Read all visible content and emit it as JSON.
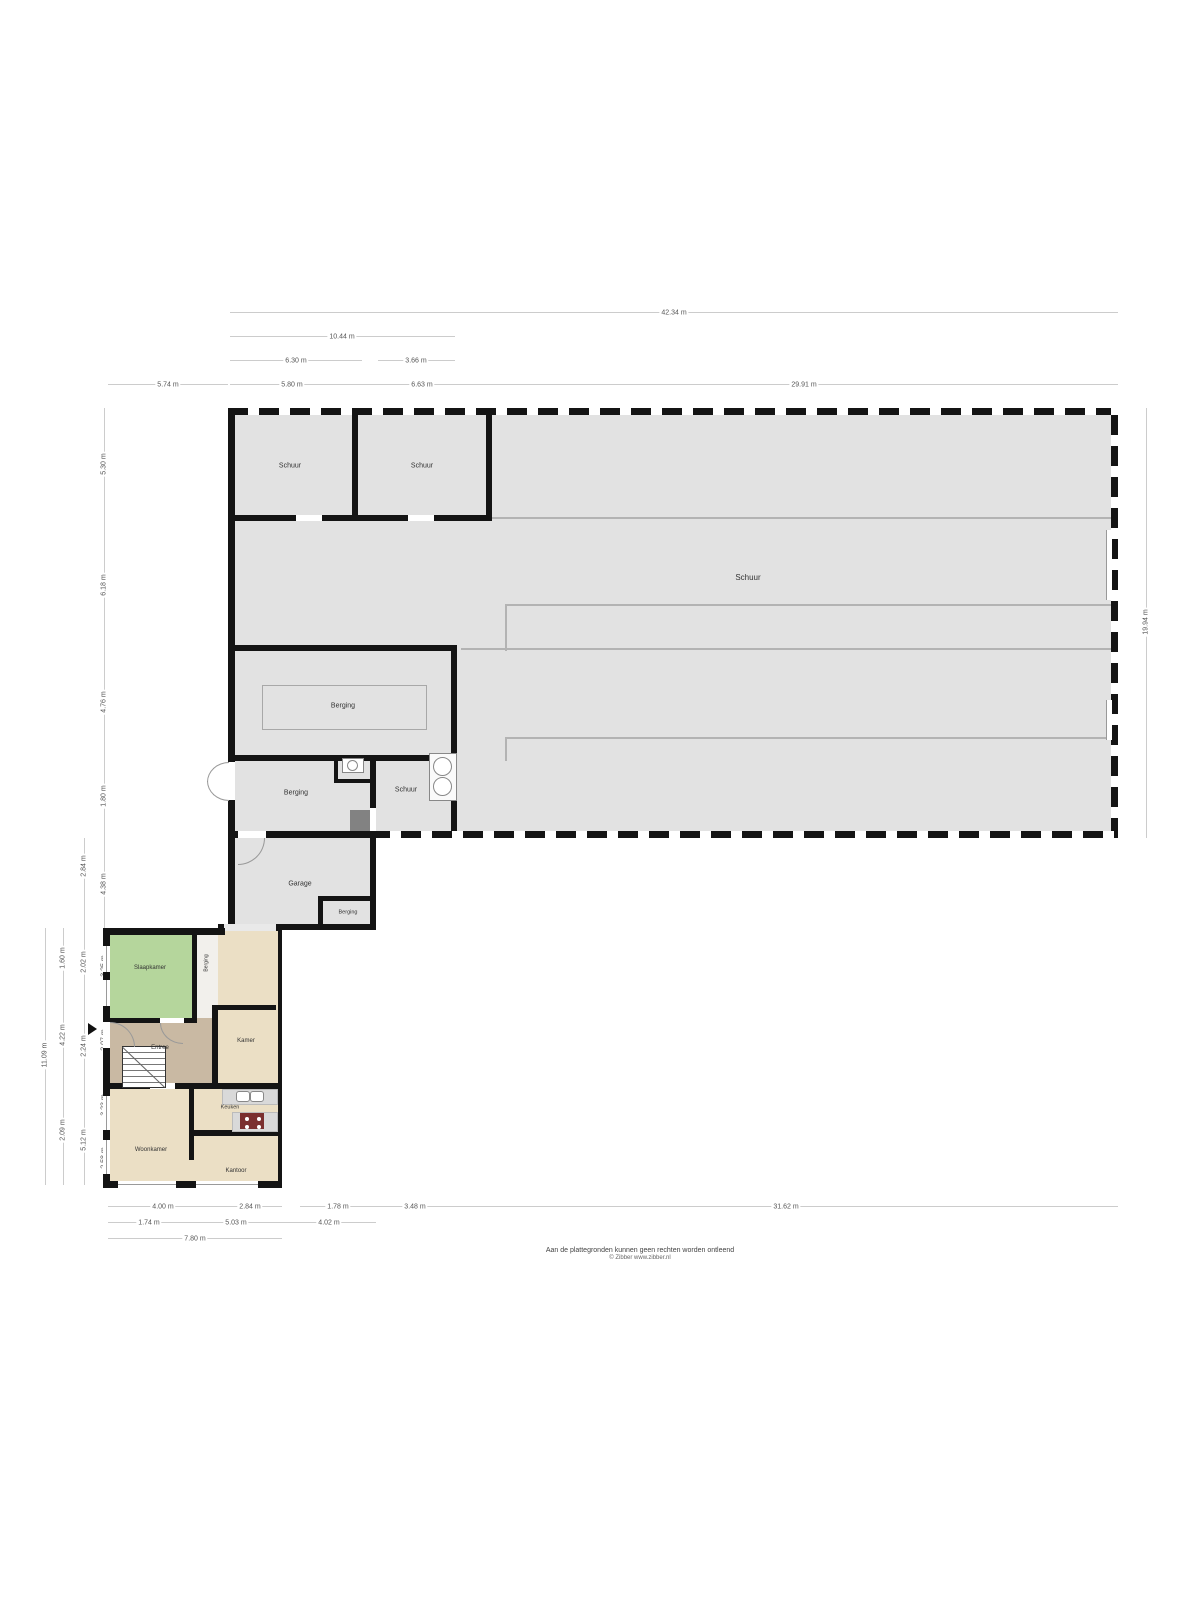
{
  "plan": {
    "rooms": [
      {
        "id": "schuur-top-left",
        "label": "Schuur"
      },
      {
        "id": "schuur-top-mid",
        "label": "Schuur"
      },
      {
        "id": "schuur-main",
        "label": "Schuur"
      },
      {
        "id": "berging-mid",
        "label": "Berging"
      },
      {
        "id": "berging-lower",
        "label": "Berging"
      },
      {
        "id": "schuur-lower",
        "label": "Schuur"
      },
      {
        "id": "garage",
        "label": "Garage"
      },
      {
        "id": "berging-garage",
        "label": "Berging"
      },
      {
        "id": "slaapkamer",
        "label": "Slaapkamer"
      },
      {
        "id": "berging-hal",
        "label": "Berging"
      },
      {
        "id": "berging-house",
        "label": "Berging"
      },
      {
        "id": "entree",
        "label": "Entree"
      },
      {
        "id": "kamer",
        "label": "Kamer"
      },
      {
        "id": "keuken",
        "label": "Keuken"
      },
      {
        "id": "woonkamer",
        "label": "Woonkamer"
      },
      {
        "id": "kantoor",
        "label": "Kantoor"
      }
    ]
  },
  "dimensions": {
    "top": [
      "42.34 m",
      "10.44 m",
      "6.30 m",
      "3.66 m",
      "5.74 m",
      "5.80 m",
      "6.63 m",
      "29.91 m"
    ],
    "left_outermost": [
      "11.09 m"
    ],
    "left_outer": [
      "1.60 m",
      "4.22 m",
      "2.09 m"
    ],
    "left_middle": [
      "2.84 m",
      "2.02 m",
      "2.24 m",
      "5.12 m"
    ],
    "left_inner": [
      "5.30 m",
      "6.18 m",
      "4.76 m",
      "1.80 m",
      "4.38 m",
      "3.25 m",
      "2.07 m",
      "3.23 m",
      "2.58 m"
    ],
    "right": [
      "19.94 m"
    ],
    "bottom_row1": [
      "4.00 m",
      "2.84 m",
      "1.78 m",
      "3.48 m",
      "31.62 m"
    ],
    "bottom_row2": [
      "1.74 m",
      "5.03 m",
      "4.02 m"
    ],
    "bottom_row3": [
      "7.80 m"
    ]
  },
  "palette": {
    "plan_gray": "#e2e2e2",
    "room_light_gray": "#e9e9e9",
    "green": "#b5d69c",
    "tan": "#c9b9a3",
    "beige": "#ebdfc5",
    "hal_white": "#f2f0ec",
    "counter": "#d9d9d9",
    "stove": "#7b2f2f",
    "wall": "#141414"
  },
  "footer": {
    "line1": "Aan de plattegronden kunnen geen rechten worden ontleend",
    "line2": "© Zibber www.zibber.nl"
  }
}
